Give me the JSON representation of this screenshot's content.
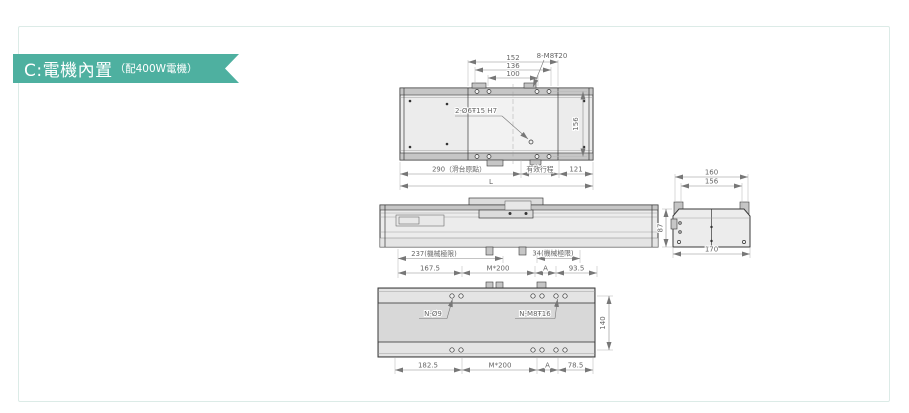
{
  "banner": {
    "title": "C:電機內置",
    "subtitle": "（配400W電機）"
  },
  "colors": {
    "banner_bg": "#4eb0a0",
    "panel_border": "#dcebe7",
    "drawing_line": "#3a3a3a",
    "dim_line": "#8a8a8a"
  },
  "top_view": {
    "d152": "152",
    "d136": "136",
    "d100": "100",
    "thread": "8-M8Ŧ20",
    "pins": "2-Ø6Ŧ15 H7",
    "d156": "156",
    "d290": "290（滑台原點）",
    "stroke": "有效行程",
    "d121": "121",
    "dL": "L"
  },
  "side_view": {
    "d237": "237(機械極限)",
    "d34": "34(機械極限)"
  },
  "mount_top_dims": {
    "d167": "167.5",
    "m200": "M*200",
    "dA": "A",
    "d93": "93.5"
  },
  "bottom_view": {
    "n9": "N-Ø9",
    "nm8": "N-M8Ŧ16",
    "d140": "140",
    "d182": "182.5",
    "m200": "M*200",
    "dA": "A",
    "d78": "78.5"
  },
  "end_view": {
    "d160": "160",
    "d156": "156",
    "d170": "170",
    "d87": "87"
  }
}
